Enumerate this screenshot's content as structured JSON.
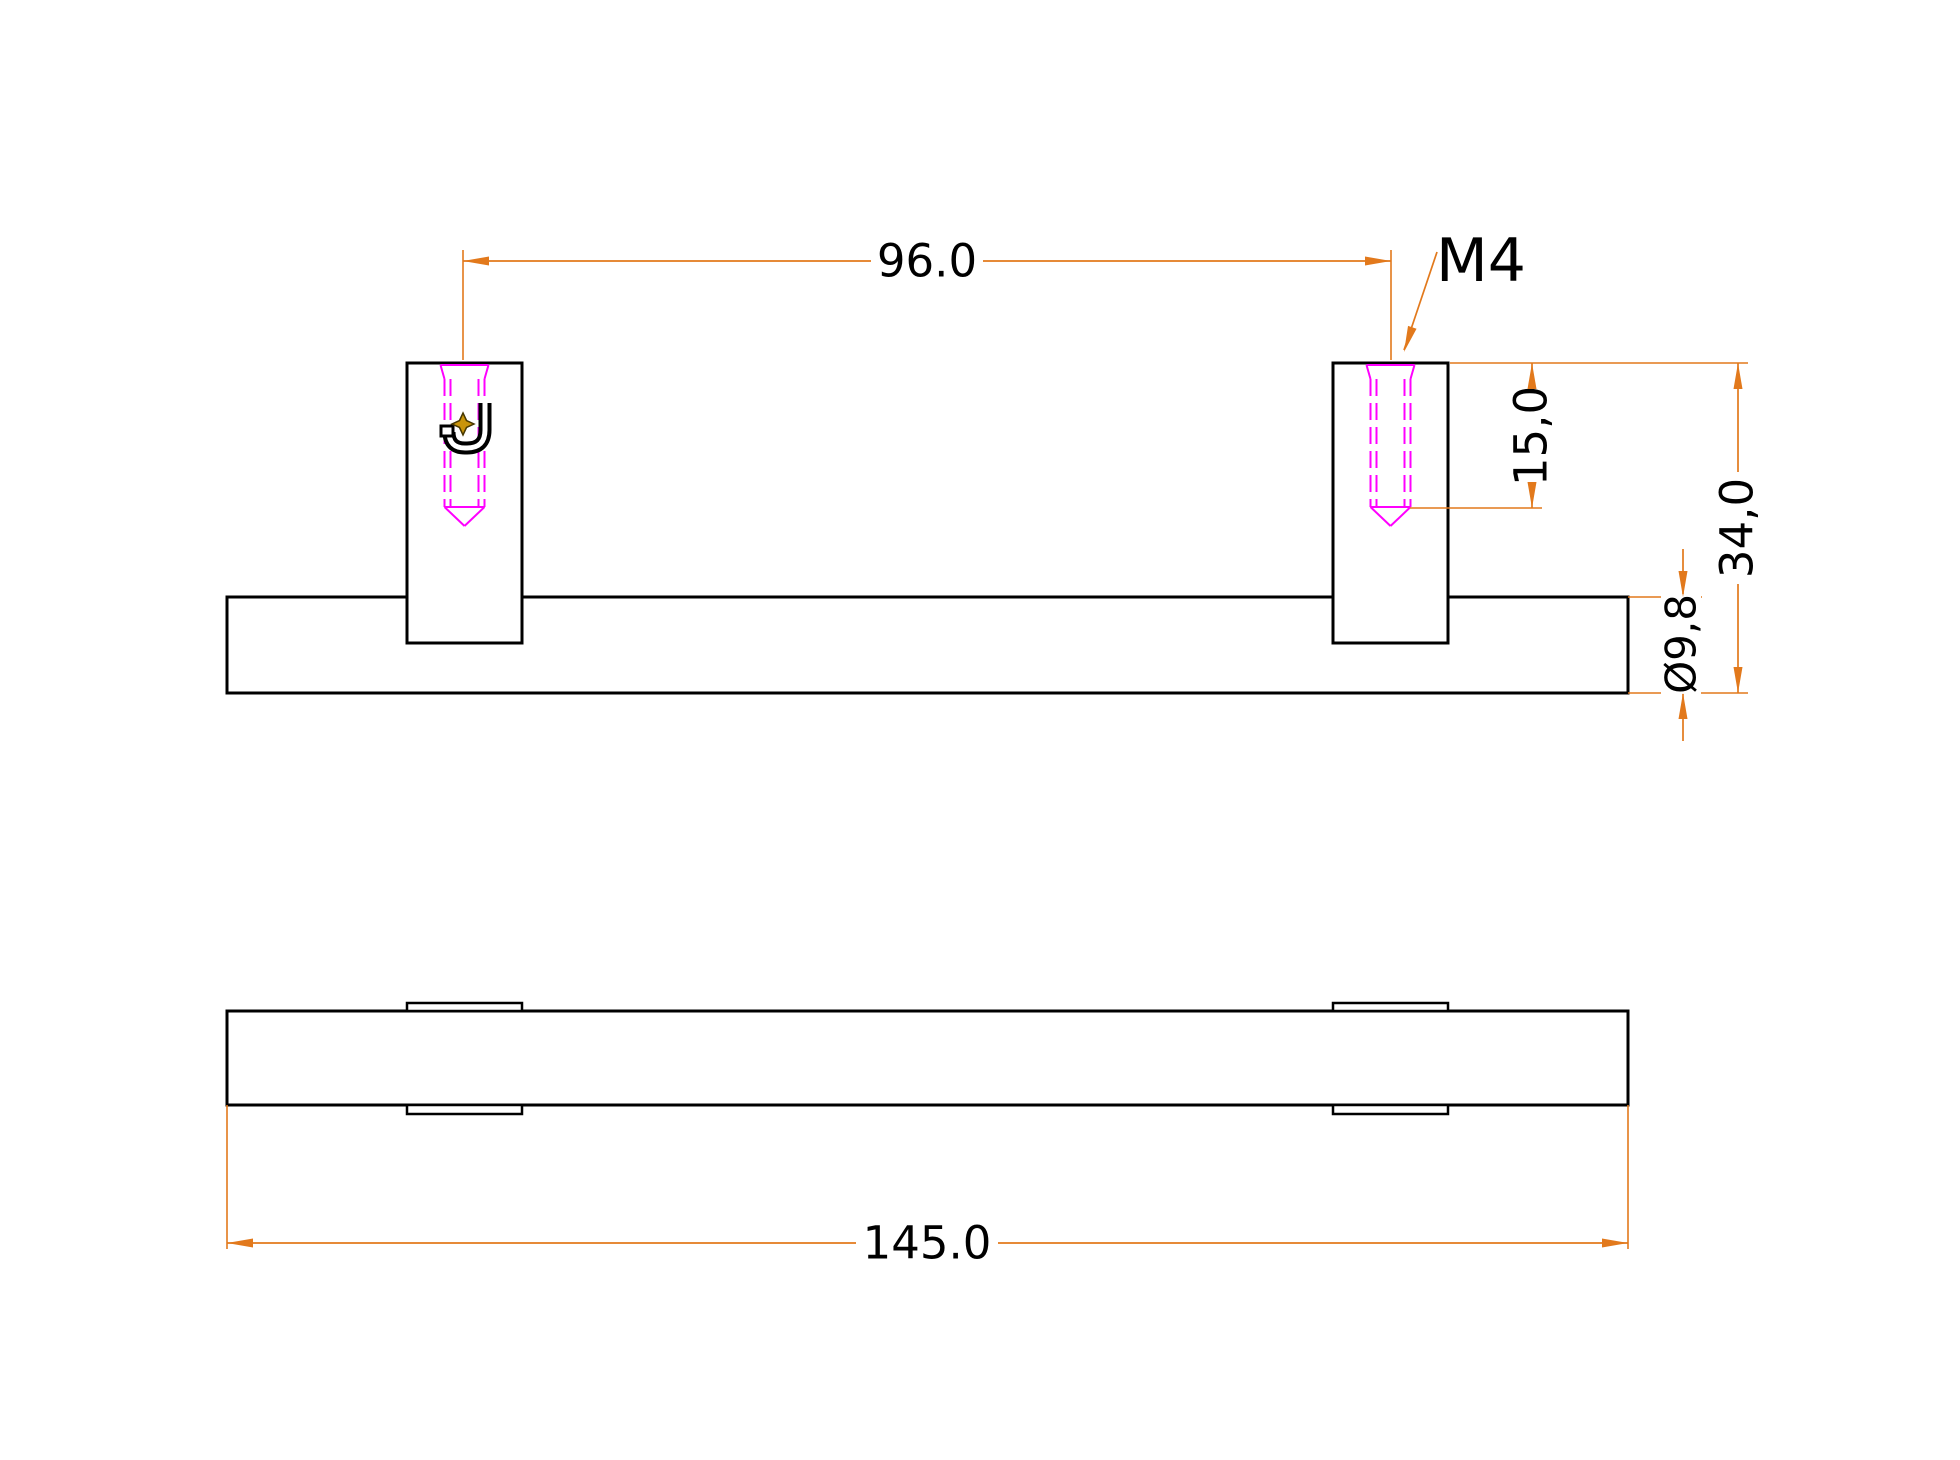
{
  "drawing": {
    "canvas": {
      "width": 1960,
      "height": 1460,
      "background": "#FFFFFF"
    },
    "colors": {
      "outline": "#000000",
      "dimension": "#E2791C",
      "thread": "#FF00FF",
      "star_fill": "#C9940B",
      "star_stroke": "#473800",
      "text": "#000000",
      "paper": "#FFFFFF"
    },
    "labels": {
      "hole_spacing": "96.0",
      "thread_spec": "M4",
      "thread_depth": "15,0",
      "total_height": "34,0",
      "bar_diameter": "Ø9,8",
      "total_length": "145.0"
    },
    "rects": [
      {
        "name": "front-view-bar-outline",
        "x": 227,
        "y": 597,
        "w": 1401,
        "h": 96,
        "sw": 3
      },
      {
        "name": "front-view-left-post-outline",
        "x": 407,
        "y": 363,
        "w": 115,
        "h": 280,
        "sw": 3
      },
      {
        "name": "front-view-right-post-outline",
        "x": 1333,
        "y": 363,
        "w": 115,
        "h": 280,
        "sw": 3
      },
      {
        "name": "top-view-bar-outline",
        "x": 227,
        "y": 1011,
        "w": 1401,
        "h": 94,
        "sw": 3
      },
      {
        "name": "top-view-left-upper-pad",
        "x": 407,
        "y": 1003,
        "w": 115,
        "h": 8,
        "sw": 2.5
      },
      {
        "name": "top-view-left-lower-pad",
        "x": 407,
        "y": 1105,
        "w": 115,
        "h": 9,
        "sw": 2.5
      },
      {
        "name": "top-view-right-upper-pad",
        "x": 1333,
        "y": 1003,
        "w": 115,
        "h": 8,
        "sw": 2.5
      },
      {
        "name": "top-view-right-lower-pad",
        "x": 1333,
        "y": 1105,
        "w": 115,
        "h": 9,
        "sw": 2.5
      }
    ],
    "threads": {
      "centers_x": [
        464.5,
        1390.5
      ],
      "top_y": 363,
      "chamfer_half": 24,
      "major_half": 20,
      "minor_half": 14,
      "chamfer_bottom_y": 379,
      "dash_bottom_y": 507,
      "tip_y": 526,
      "dash_pattern": "17 7",
      "sw": 2
    },
    "ext_lines": [
      {
        "name": "ext-line-96-left",
        "x1": 463,
        "y1": 250,
        "x2": 463,
        "y2": 360
      },
      {
        "name": "ext-line-96-right",
        "x1": 1391,
        "y1": 250,
        "x2": 1391,
        "y2": 360
      },
      {
        "name": "ext-line-post-top",
        "x1": 1450,
        "y1": 363,
        "x2": 1748,
        "y2": 363
      },
      {
        "name": "ext-line-thread-depth",
        "x1": 1410,
        "y1": 508,
        "x2": 1542,
        "y2": 508
      },
      {
        "name": "ext-line-bar-top",
        "x1": 1628,
        "y1": 597,
        "x2": 1702,
        "y2": 597
      },
      {
        "name": "ext-line-bar-bottom",
        "x1": 1628,
        "y1": 693,
        "x2": 1748,
        "y2": 693
      },
      {
        "name": "ext-line-145-left",
        "x1": 227,
        "y1": 1105,
        "x2": 227,
        "y2": 1249
      },
      {
        "name": "ext-line-145-right",
        "x1": 1628,
        "y1": 1105,
        "x2": 1628,
        "y2": 1249
      }
    ],
    "dim_lines": [
      {
        "name": "dim-line-96",
        "x1": 463,
        "y1": 261,
        "x2": 1391,
        "y2": 261
      },
      {
        "name": "dim-line-15",
        "x1": 1532,
        "y1": 363,
        "x2": 1532,
        "y2": 508
      },
      {
        "name": "dim-line-34",
        "x1": 1738,
        "y1": 363,
        "x2": 1738,
        "y2": 693
      },
      {
        "name": "dim-line-diameter-upper",
        "x1": 1683,
        "y1": 549,
        "x2": 1683,
        "y2": 597
      },
      {
        "name": "dim-line-diameter-lower",
        "x1": 1683,
        "y1": 693,
        "x2": 1683,
        "y2": 741
      },
      {
        "name": "dim-line-145",
        "x1": 227,
        "y1": 1243,
        "x2": 1628,
        "y2": 1243
      },
      {
        "name": "m4-leader-line",
        "x1": 1437,
        "y1": 252,
        "x2": 1404,
        "y2": 350
      }
    ],
    "arrows": [
      {
        "name": "arrow-96-left",
        "x": 463,
        "y": 261,
        "angle": 180
      },
      {
        "name": "arrow-96-right",
        "x": 1391,
        "y": 261,
        "angle": 0
      },
      {
        "name": "arrow-15-top",
        "x": 1532,
        "y": 363,
        "angle": -90
      },
      {
        "name": "arrow-15-bottom",
        "x": 1532,
        "y": 508,
        "angle": 90
      },
      {
        "name": "arrow-34-top",
        "x": 1738,
        "y": 363,
        "angle": -90
      },
      {
        "name": "arrow-34-bottom",
        "x": 1738,
        "y": 693,
        "angle": 90
      },
      {
        "name": "arrow-diameter-top",
        "x": 1683,
        "y": 597,
        "angle": 90
      },
      {
        "name": "arrow-diameter-bottom",
        "x": 1683,
        "y": 693,
        "angle": -90
      },
      {
        "name": "arrow-145-left",
        "x": 227,
        "y": 1243,
        "angle": 180
      },
      {
        "name": "arrow-145-right",
        "x": 1628,
        "y": 1243,
        "angle": 0
      },
      {
        "name": "m4-leader-arrow",
        "x": 1404,
        "y": 352,
        "angle": 108.6
      }
    ],
    "texts": [
      {
        "name": "dim-96-label",
        "key": "hole_spacing",
        "x": 927,
        "y": 261,
        "rot": 0,
        "size": 45,
        "bg_w": 112,
        "bg_h": 42
      },
      {
        "name": "m4-label",
        "key": "thread_spec",
        "x": 1481,
        "y": 261,
        "rot": 0,
        "size": 60,
        "bg_w": 0,
        "bg_h": 0
      },
      {
        "name": "dim-15-label",
        "key": "thread_depth",
        "x": 1531,
        "y": 436,
        "rot": -90,
        "size": 45,
        "bg_w": 112,
        "bg_h": 42
      },
      {
        "name": "dim-34-label",
        "key": "total_height",
        "x": 1737,
        "y": 528,
        "rot": -90,
        "size": 45,
        "bg_w": 112,
        "bg_h": 42
      },
      {
        "name": "dim-diameter-label",
        "key": "bar_diameter",
        "x": 1681,
        "y": 644,
        "rot": -90,
        "size": 42,
        "bg_w": 100,
        "bg_h": 40
      },
      {
        "name": "dim-145-label",
        "key": "total_length",
        "x": 927,
        "y": 1243,
        "rot": 0,
        "size": 45,
        "bg_w": 142,
        "bg_h": 42
      }
    ],
    "j_symbol": {
      "skeleton": "M485 403 L485 430 Q485 448 467 448 L465 448 Q449 448 449 432",
      "outer_sw": 13,
      "inner_sw": 5,
      "serif": {
        "x": 441,
        "y": 426,
        "w": 12,
        "h": 10,
        "sw": 3
      }
    },
    "star": {
      "path": "M463 413 L466.5 420.5 L474 424 L466.5 427.5 L463 435 L459.5 427.5 L452 424 L459.5 420.5 Z"
    }
  }
}
